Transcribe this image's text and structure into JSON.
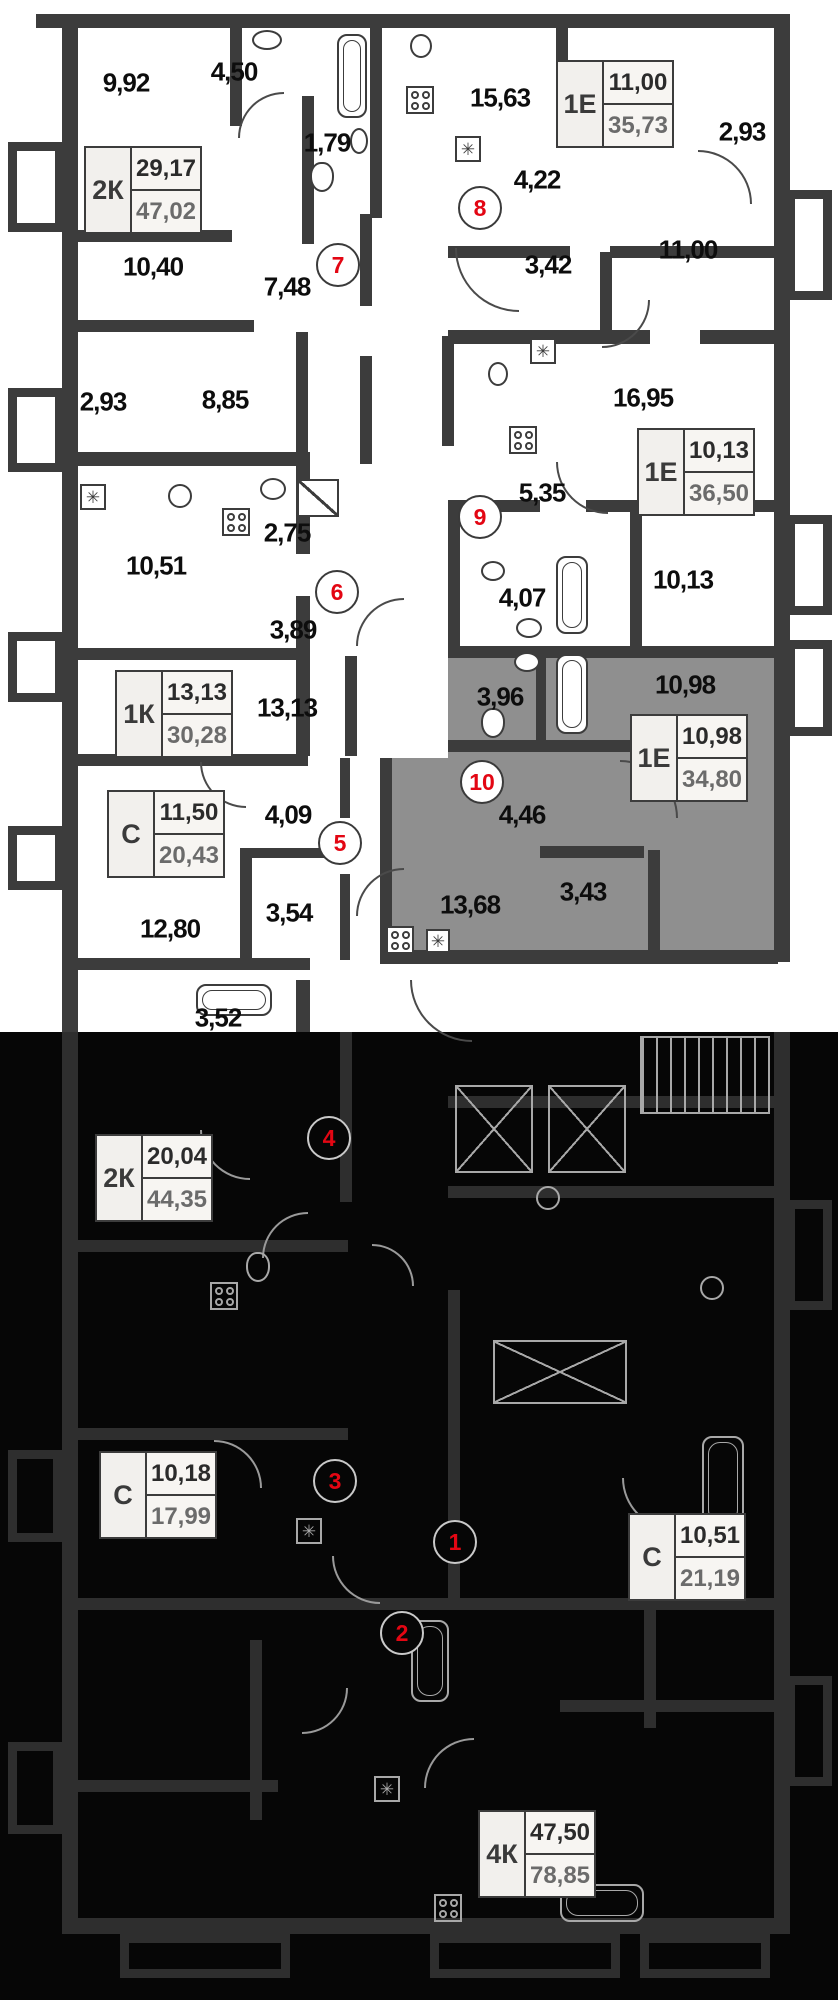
{
  "colors": {
    "wall": "#3c3c3c",
    "dark_wall": "#2e2e2e",
    "black_zone": "#060606",
    "highlight_gray": "#8f8f8f",
    "tag_bg": "#f2f0ed",
    "marker_red": "#e30613",
    "dark_line": "#a8a8a8"
  },
  "boundary_label": "3,52",
  "rooms": {
    "light": [
      {
        "label": "9,92",
        "x": 126,
        "y": 83
      },
      {
        "label": "4,50",
        "x": 234,
        "y": 72
      },
      {
        "label": "15,63",
        "x": 500,
        "y": 98
      },
      {
        "label": "2,93",
        "x": 742,
        "y": 132
      },
      {
        "label": "1,79",
        "x": 327,
        "y": 143
      },
      {
        "label": "4,22",
        "x": 537,
        "y": 180
      },
      {
        "label": "11,00",
        "x": 688,
        "y": 250
      },
      {
        "label": "3,42",
        "x": 548,
        "y": 265
      },
      {
        "label": "10,40",
        "x": 153,
        "y": 267
      },
      {
        "label": "7,48",
        "x": 287,
        "y": 287
      },
      {
        "label": "2,93",
        "x": 103,
        "y": 402
      },
      {
        "label": "8,85",
        "x": 225,
        "y": 400
      },
      {
        "label": "16,95",
        "x": 643,
        "y": 398
      },
      {
        "label": "5,35",
        "x": 542,
        "y": 493
      },
      {
        "label": "2,75",
        "x": 287,
        "y": 533
      },
      {
        "label": "10,51",
        "x": 156,
        "y": 566
      },
      {
        "label": "10,13",
        "x": 683,
        "y": 580
      },
      {
        "label": "4,07",
        "x": 522,
        "y": 598
      },
      {
        "label": "3,89",
        "x": 293,
        "y": 630
      },
      {
        "label": "13,13",
        "x": 287,
        "y": 708
      },
      {
        "label": "4,09",
        "x": 288,
        "y": 815
      },
      {
        "label": "3,54",
        "x": 289,
        "y": 913
      },
      {
        "label": "12,80",
        "x": 170,
        "y": 929
      }
    ],
    "gray": [
      {
        "label": "3,96",
        "x": 500,
        "y": 697
      },
      {
        "label": "10,98",
        "x": 685,
        "y": 685
      },
      {
        "label": "4,46",
        "x": 522,
        "y": 815
      },
      {
        "label": "13,68",
        "x": 470,
        "y": 905
      },
      {
        "label": "3,43",
        "x": 583,
        "y": 892
      }
    ]
  },
  "units": [
    {
      "type": "2К",
      "rooms_area": "29,17",
      "total_area": "47,02",
      "x": 84,
      "y": 146,
      "section": "light"
    },
    {
      "type": "1Е",
      "rooms_area": "11,00",
      "total_area": "35,73",
      "x": 556,
      "y": 60,
      "section": "light"
    },
    {
      "type": "1Е",
      "rooms_area": "10,13",
      "total_area": "36,50",
      "x": 637,
      "y": 428,
      "section": "light"
    },
    {
      "type": "1К",
      "rooms_area": "13,13",
      "total_area": "30,28",
      "x": 115,
      "y": 670,
      "section": "light"
    },
    {
      "type": "С",
      "rooms_area": "11,50",
      "total_area": "20,43",
      "x": 107,
      "y": 790,
      "section": "light"
    },
    {
      "type": "1Е",
      "rooms_area": "10,98",
      "total_area": "34,80",
      "x": 630,
      "y": 714,
      "section": "light",
      "highlighted": true
    },
    {
      "type": "2К",
      "rooms_area": "20,04",
      "total_area": "44,35",
      "x": 95,
      "y": 1134,
      "section": "dark"
    },
    {
      "type": "С",
      "rooms_area": "10,18",
      "total_area": "17,99",
      "x": 99,
      "y": 1451,
      "section": "dark"
    },
    {
      "type": "С",
      "rooms_area": "10,51",
      "total_area": "21,19",
      "x": 628,
      "y": 1513,
      "section": "dark"
    },
    {
      "type": "4К",
      "rooms_area": "47,50",
      "total_area": "78,85",
      "x": 478,
      "y": 1810,
      "section": "dark"
    }
  ],
  "entrances": [
    {
      "num": "7",
      "x": 338,
      "y": 265,
      "section": "light"
    },
    {
      "num": "8",
      "x": 480,
      "y": 208,
      "section": "light"
    },
    {
      "num": "9",
      "x": 480,
      "y": 517,
      "section": "light"
    },
    {
      "num": "6",
      "x": 337,
      "y": 592,
      "section": "light"
    },
    {
      "num": "10",
      "x": 482,
      "y": 782,
      "section": "light"
    },
    {
      "num": "5",
      "x": 340,
      "y": 843,
      "section": "light"
    },
    {
      "num": "4",
      "x": 329,
      "y": 1138,
      "section": "dark"
    },
    {
      "num": "3",
      "x": 335,
      "y": 1481,
      "section": "dark"
    },
    {
      "num": "1",
      "x": 455,
      "y": 1542,
      "section": "dark"
    },
    {
      "num": "2",
      "x": 402,
      "y": 1633,
      "section": "dark"
    }
  ],
  "fixtures": [
    {
      "kind": "tub",
      "x": 337,
      "y": 34,
      "w": 30,
      "h": 84,
      "section": "light"
    },
    {
      "kind": "sink",
      "x": 410,
      "y": 34,
      "w": 22,
      "h": 24,
      "section": "light"
    },
    {
      "kind": "stove",
      "x": 406,
      "y": 86,
      "w": 28,
      "h": 28,
      "section": "light"
    },
    {
      "kind": "washer",
      "x": 455,
      "y": 136,
      "w": 26,
      "h": 26,
      "section": "light"
    },
    {
      "kind": "toilet",
      "x": 310,
      "y": 162,
      "w": 24,
      "h": 30,
      "section": "light"
    },
    {
      "kind": "sink",
      "x": 350,
      "y": 128,
      "w": 18,
      "h": 26,
      "section": "light"
    },
    {
      "kind": "sink",
      "x": 252,
      "y": 30,
      "w": 30,
      "h": 20,
      "section": "light"
    },
    {
      "kind": "washer",
      "x": 80,
      "y": 484,
      "w": 26,
      "h": 26,
      "section": "light"
    },
    {
      "kind": "sink",
      "x": 168,
      "y": 484,
      "w": 24,
      "h": 24,
      "section": "light"
    },
    {
      "kind": "stove",
      "x": 222,
      "y": 508,
      "w": 28,
      "h": 28,
      "section": "light"
    },
    {
      "kind": "sink",
      "x": 260,
      "y": 478,
      "w": 26,
      "h": 22,
      "section": "light"
    },
    {
      "kind": "shower",
      "x": 297,
      "y": 479,
      "w": 42,
      "h": 38,
      "section": "light"
    },
    {
      "kind": "stove",
      "x": 509,
      "y": 426,
      "w": 28,
      "h": 28,
      "section": "light"
    },
    {
      "kind": "sink",
      "x": 488,
      "y": 362,
      "w": 20,
      "h": 24,
      "section": "light"
    },
    {
      "kind": "washer",
      "x": 530,
      "y": 338,
      "w": 26,
      "h": 26,
      "section": "light"
    },
    {
      "kind": "sink",
      "x": 481,
      "y": 561,
      "w": 24,
      "h": 20,
      "section": "light"
    },
    {
      "kind": "tub",
      "x": 556,
      "y": 556,
      "w": 32,
      "h": 78,
      "section": "light"
    },
    {
      "kind": "sink",
      "x": 516,
      "y": 618,
      "w": 26,
      "h": 20,
      "section": "light"
    },
    {
      "kind": "toilet",
      "x": 481,
      "y": 708,
      "w": 24,
      "h": 30,
      "section": "light"
    },
    {
      "kind": "tub",
      "x": 556,
      "y": 654,
      "w": 32,
      "h": 80,
      "section": "light"
    },
    {
      "kind": "sink",
      "x": 514,
      "y": 652,
      "w": 26,
      "h": 20,
      "section": "light"
    },
    {
      "kind": "stove",
      "x": 386,
      "y": 926,
      "w": 28,
      "h": 28,
      "section": "light"
    },
    {
      "kind": "washer",
      "x": 426,
      "y": 929,
      "w": 24,
      "h": 24,
      "section": "light"
    },
    {
      "kind": "tub",
      "x": 196,
      "y": 984,
      "w": 76,
      "h": 32,
      "section": "light"
    },
    {
      "kind": "elevator",
      "x": 455,
      "y": 1085,
      "w": 78,
      "h": 88,
      "section": "dark"
    },
    {
      "kind": "elevator",
      "x": 548,
      "y": 1085,
      "w": 78,
      "h": 88,
      "section": "dark"
    },
    {
      "kind": "stairs",
      "x": 640,
      "y": 1036,
      "w": 130,
      "h": 78,
      "section": "dark"
    },
    {
      "kind": "bed",
      "x": 493,
      "y": 1340,
      "w": 134,
      "h": 64,
      "section": "dark"
    },
    {
      "kind": "tub",
      "x": 702,
      "y": 1436,
      "w": 42,
      "h": 92,
      "section": "dark"
    },
    {
      "kind": "tub",
      "x": 411,
      "y": 1620,
      "w": 38,
      "h": 82,
      "section": "dark"
    },
    {
      "kind": "stove",
      "x": 210,
      "y": 1282,
      "w": 28,
      "h": 28,
      "section": "dark"
    },
    {
      "kind": "toilet",
      "x": 246,
      "y": 1252,
      "w": 24,
      "h": 30,
      "section": "dark"
    },
    {
      "kind": "sink",
      "x": 536,
      "y": 1186,
      "w": 24,
      "h": 24,
      "section": "dark"
    },
    {
      "kind": "washer",
      "x": 296,
      "y": 1518,
      "w": 26,
      "h": 26,
      "section": "dark"
    },
    {
      "kind": "washer",
      "x": 374,
      "y": 1776,
      "w": 26,
      "h": 26,
      "section": "dark"
    },
    {
      "kind": "stove",
      "x": 434,
      "y": 1894,
      "w": 28,
      "h": 28,
      "section": "dark"
    },
    {
      "kind": "sink",
      "x": 700,
      "y": 1276,
      "w": 24,
      "h": 24,
      "section": "dark"
    },
    {
      "kind": "tub",
      "x": 560,
      "y": 1884,
      "w": 84,
      "h": 38,
      "section": "dark"
    }
  ]
}
